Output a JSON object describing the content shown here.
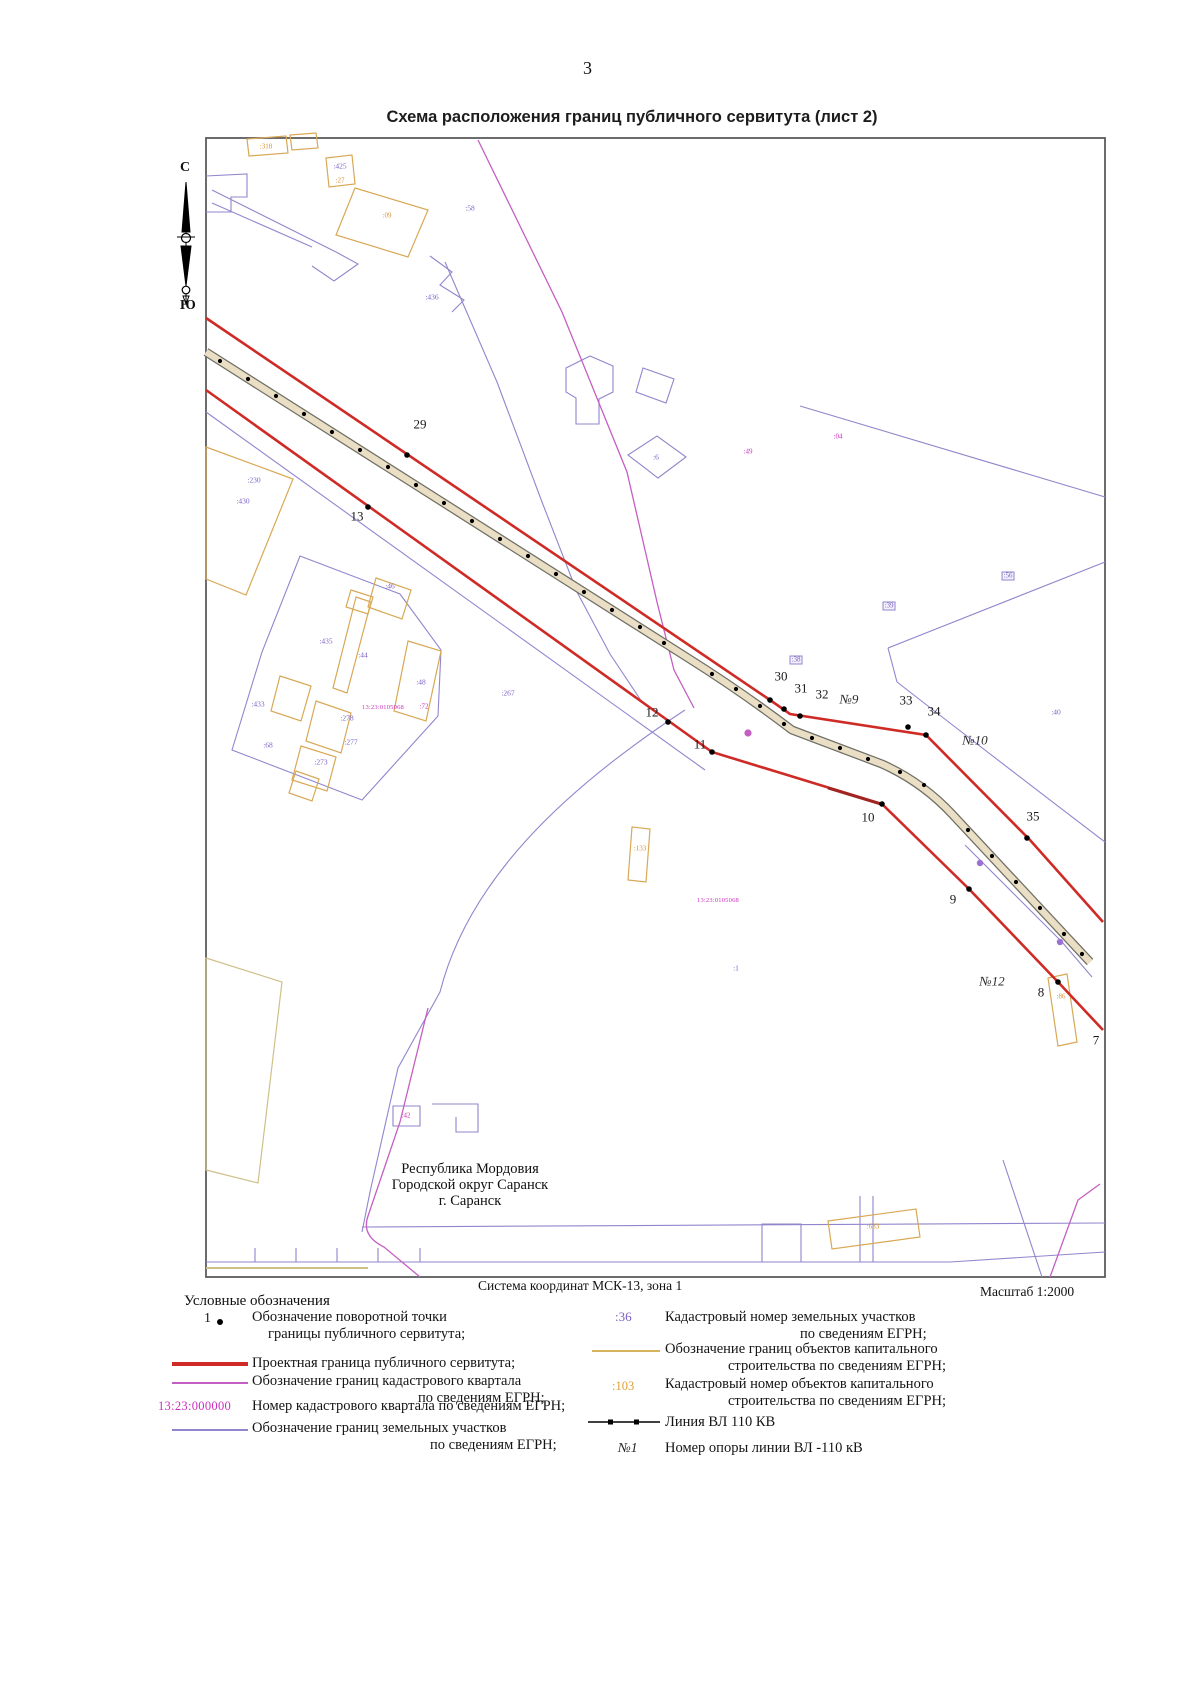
{
  "page": {
    "number": "3",
    "title": "Схема расположения границ публичного сервитута (лист 2)"
  },
  "map": {
    "compass": {
      "north": "С",
      "south": "Ю"
    },
    "region_lines": [
      "Республика Мордовия",
      "Городской округ Саранск",
      "г. Саранск"
    ],
    "colors": {
      "servitude_red": "#cf2b26",
      "quarter_magenta": "#c45fc2",
      "parcel_purple": "#9186cd",
      "building_orange": "#d8a855",
      "vl_line_gray": "#6f6f66",
      "vl_fill_tan": "#eadfc4"
    },
    "labels": [
      {
        "t": "29",
        "x": 420,
        "y": 424,
        "c": "pt"
      },
      {
        "t": "13",
        "x": 357,
        "y": 516,
        "c": "pt"
      },
      {
        "t": "30",
        "x": 781,
        "y": 676,
        "c": "pt"
      },
      {
        "t": "31",
        "x": 801,
        "y": 688,
        "c": "pt"
      },
      {
        "t": "32",
        "x": 822,
        "y": 694,
        "c": "pt"
      },
      {
        "t": "№9",
        "x": 849,
        "y": 699,
        "c": "pyl"
      },
      {
        "t": "33",
        "x": 906,
        "y": 700,
        "c": "pt"
      },
      {
        "t": "34",
        "x": 934,
        "y": 711,
        "c": "pt"
      },
      {
        "t": "№10",
        "x": 975,
        "y": 740,
        "c": "pyl"
      },
      {
        "t": "35",
        "x": 1033,
        "y": 816,
        "c": "pt"
      },
      {
        "t": "12",
        "x": 652,
        "y": 712,
        "c": "pt"
      },
      {
        "t": "11",
        "x": 700,
        "y": 744,
        "c": "pt"
      },
      {
        "t": "10",
        "x": 868,
        "y": 817,
        "c": "pt"
      },
      {
        "t": "9",
        "x": 953,
        "y": 899,
        "c": "pt"
      },
      {
        "t": "№12",
        "x": 992,
        "y": 981,
        "c": "pyl"
      },
      {
        "t": "8",
        "x": 1041,
        "y": 992,
        "c": "pt"
      },
      {
        "t": "7",
        "x": 1096,
        "y": 1040,
        "c": "pt"
      },
      {
        "t": "13:23:0105068",
        "x": 383,
        "y": 708,
        "c": "q"
      },
      {
        "t": ":72",
        "x": 424,
        "y": 707,
        "c": "mg"
      },
      {
        "t": "13:23:0105068",
        "x": 718,
        "y": 901,
        "c": "q"
      },
      {
        "t": ":42",
        "x": 406,
        "y": 1116,
        "c": "mg"
      },
      {
        "t": ":318",
        "x": 266,
        "y": 147,
        "c": "ol"
      },
      {
        "t": ":09",
        "x": 387,
        "y": 216,
        "c": "ol"
      },
      {
        "t": ":27",
        "x": 340,
        "y": 181,
        "c": "ol"
      },
      {
        "t": ":425",
        "x": 340,
        "y": 166,
        "c": "pl"
      },
      {
        "t": ":58",
        "x": 470,
        "y": 208,
        "c": "pl"
      },
      {
        "t": ":436",
        "x": 432,
        "y": 297,
        "c": "pl"
      },
      {
        "t": ":230",
        "x": 254,
        "y": 480,
        "c": "pl"
      },
      {
        "t": ":430",
        "x": 243,
        "y": 501,
        "c": "pl"
      },
      {
        "t": ":46",
        "x": 390,
        "y": 586,
        "c": "pl"
      },
      {
        "t": ":435",
        "x": 326,
        "y": 641,
        "c": "pl"
      },
      {
        "t": ":44",
        "x": 363,
        "y": 655,
        "c": "pl"
      },
      {
        "t": ":48",
        "x": 421,
        "y": 682,
        "c": "pl"
      },
      {
        "t": ":267",
        "x": 508,
        "y": 693,
        "c": "pl"
      },
      {
        "t": ":433",
        "x": 258,
        "y": 704,
        "c": "pl"
      },
      {
        "t": ":278",
        "x": 347,
        "y": 718,
        "c": "pl"
      },
      {
        "t": ":277",
        "x": 351,
        "y": 742,
        "c": "pl"
      },
      {
        "t": ":273",
        "x": 321,
        "y": 762,
        "c": "pl"
      },
      {
        "t": ":68",
        "x": 268,
        "y": 745,
        "c": "pl"
      },
      {
        "t": ":6",
        "x": 656,
        "y": 457,
        "c": "pl"
      },
      {
        "t": ":49",
        "x": 748,
        "y": 452,
        "c": "mg"
      },
      {
        "t": ":04",
        "x": 838,
        "y": 437,
        "c": "mg"
      },
      {
        "t": ":39",
        "x": 889,
        "y": 606,
        "c": "plb"
      },
      {
        "t": ":38",
        "x": 796,
        "y": 660,
        "c": "plb"
      },
      {
        "t": ":56",
        "x": 1008,
        "y": 576,
        "c": "plb"
      },
      {
        "t": ":40",
        "x": 1056,
        "y": 712,
        "c": "pl"
      },
      {
        "t": ":1",
        "x": 736,
        "y": 968,
        "c": "pl"
      },
      {
        "t": ":133",
        "x": 640,
        "y": 849,
        "c": "ol"
      },
      {
        "t": ":86",
        "x": 1061,
        "y": 997,
        "c": "ol"
      },
      {
        "t": ":633",
        "x": 873,
        "y": 1227,
        "c": "ol"
      }
    ]
  },
  "footer": {
    "coordinate_system": "Система координат МСК-13, зона 1",
    "scale": "Масштаб 1:2000"
  },
  "legend": {
    "title": "Условные обозначения",
    "left": [
      {
        "point_label": "1",
        "lines": [
          "Обозначение поворотной точки",
          "границы публичного сервитута;"
        ]
      },
      {
        "lines": [
          "Проектная граница публичного сервитута;"
        ]
      },
      {
        "lines": [
          "Обозначение границ кадастрового квартала",
          "по сведениям ЕГРН;"
        ]
      },
      {
        "sym_text": "13:23:000000",
        "lines": [
          "Номер кадастрового квартала по сведениям ЕГРН;"
        ]
      },
      {
        "lines": [
          "Обозначение границ земельных участков",
          "по сведениям ЕГРН;"
        ]
      }
    ],
    "right": [
      {
        "sym_text": ":36",
        "lines": [
          "Кадастровый номер земельных участков",
          "по сведениям ЕГРН;"
        ]
      },
      {
        "lines": [
          "Обозначение границ объектов капитального",
          "строительства по сведениям ЕГРН;"
        ]
      },
      {
        "sym_text": ":103",
        "lines": [
          "Кадастровый номер объектов капитального",
          "строительства по сведениям ЕГРН;"
        ]
      },
      {
        "lines": [
          "Линия ВЛ 110 КВ"
        ]
      },
      {
        "sym_text": "№1",
        "lines": [
          "Номер опоры линии ВЛ -110 кВ"
        ]
      }
    ]
  }
}
